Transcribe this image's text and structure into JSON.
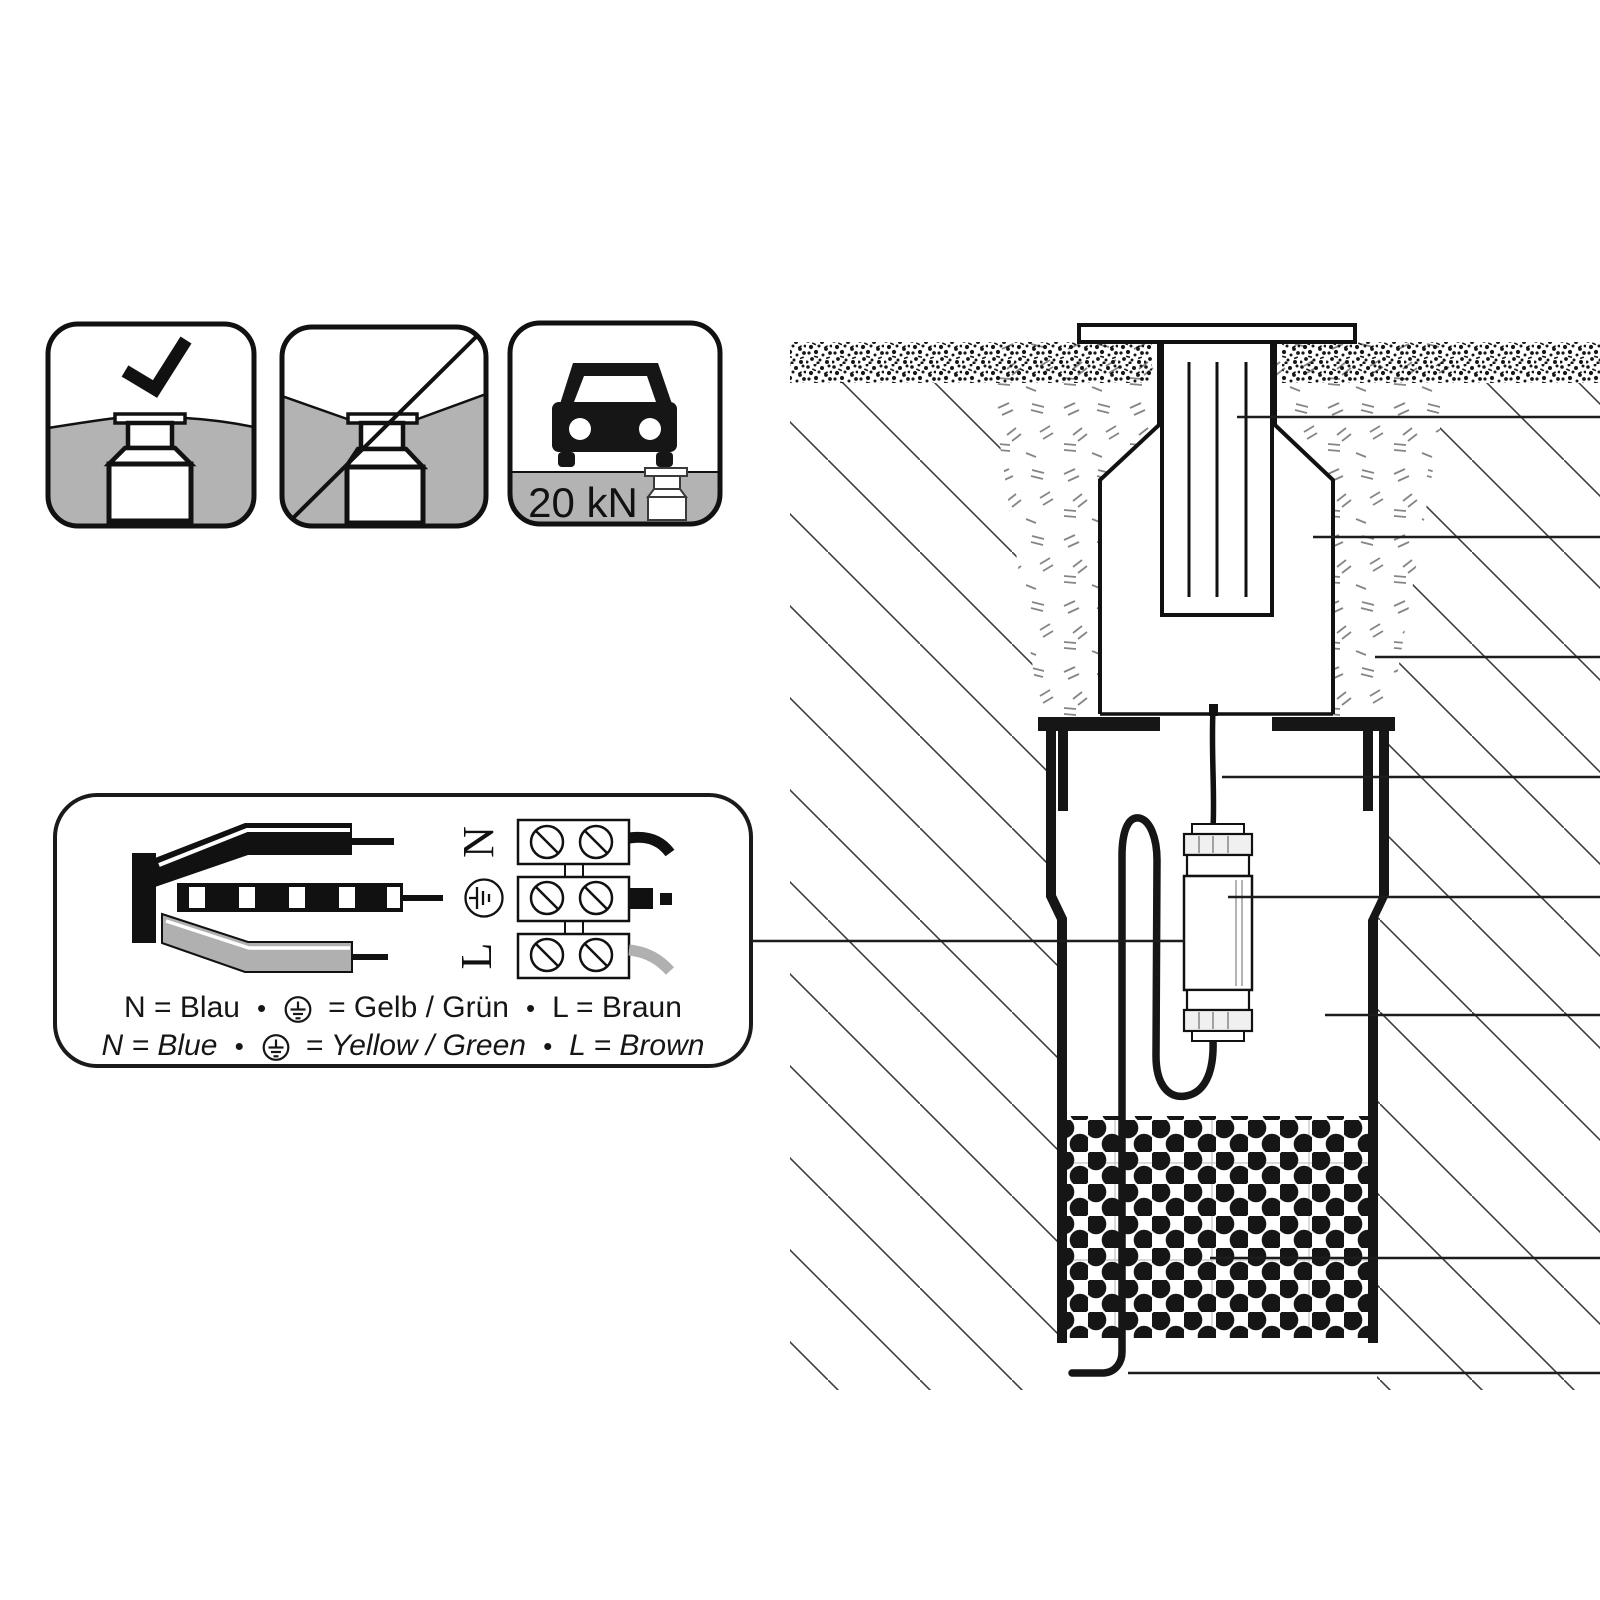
{
  "pictograms": {
    "allowed_icon": "flush-installation-ok",
    "forbidden_icon": "recessed-installation-forbidden",
    "drive_over_icon": "vehicle-load-rating",
    "load_label": "20 kN"
  },
  "wiring": {
    "terminals": {
      "n": "N",
      "l": "L",
      "earth_icon": "earth-symbol"
    },
    "legend": {
      "bullet": "•",
      "de": {
        "n": "N = Blau",
        "earth": "= Gelb / Grün",
        "l": "L = Braun"
      },
      "en": {
        "n": "N = Blue",
        "earth": "= Yellow / Green",
        "l": "L = Brown"
      }
    }
  },
  "colors": {
    "ground_gray": "#b3b3b3",
    "wire_gray": "#b0b0b0",
    "line_black": "#111111"
  }
}
